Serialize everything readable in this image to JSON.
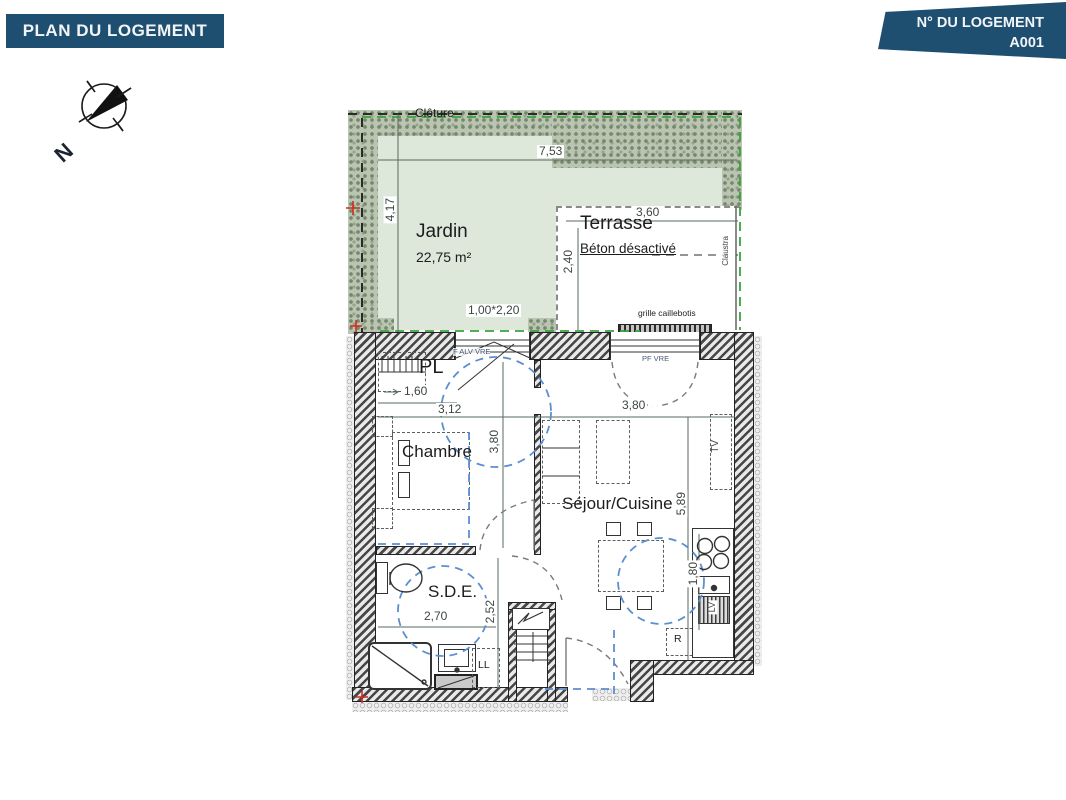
{
  "header": {
    "title": "PLAN DU LOGEMENT"
  },
  "unit_banner": {
    "label": "N° DU LOGEMENT",
    "number": "A001"
  },
  "compass": {
    "north": "N"
  },
  "colors": {
    "banner_blue": "#1e4f70",
    "garden_green": "#dde7da",
    "hedge_green": "#8d9c85",
    "boundary_green": "#3aa33a",
    "accessibility_blue": "#5b8fd0",
    "marker_red": "#d02b20"
  },
  "outdoor": {
    "fence_label": "Clôture",
    "garden": {
      "name": "Jardin",
      "area": "22,75 m²",
      "width": "7,53",
      "depth": "4,17",
      "gate": "1,00*2,20"
    },
    "terrace": {
      "name": "Terrasse",
      "finish": "Béton désactivé",
      "width": "3,60",
      "depth": "2,40",
      "screen": "Claustra",
      "grate": "grille caillebotis"
    }
  },
  "rooms": {
    "closet": {
      "name": "PL",
      "width": "1,60"
    },
    "bedroom": {
      "name": "Chambre",
      "width": "3,12",
      "depth": "3,80",
      "window": "F ALV VRE"
    },
    "living": {
      "name": "Séjour/Cuisine",
      "width": "3,80",
      "depth": "5,89",
      "kitchen_run": "1,80",
      "window": "PF VRE"
    },
    "shower_room": {
      "name": "S.D.E.",
      "width": "2,70",
      "depth": "2,52"
    }
  },
  "equipment": {
    "tv": "TV",
    "washing_machine": "LL",
    "dishwasher": "LV",
    "fridge": "R"
  }
}
